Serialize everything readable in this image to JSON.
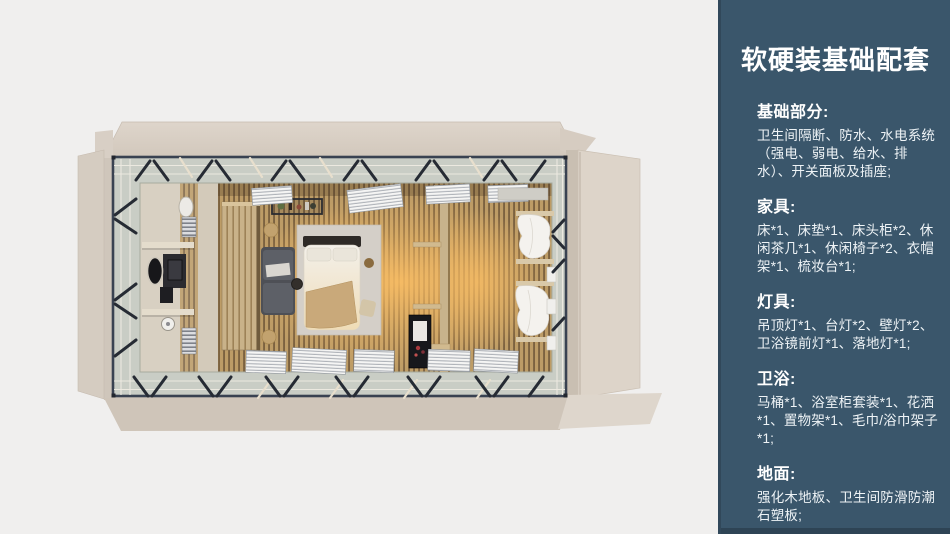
{
  "panel": {
    "title": "软硬装基础配套",
    "sections": [
      {
        "id": "basics",
        "heading": "基础部分:",
        "body": "卫生间隔断、防水、水电系统（强电、弱电、给水、排水）、开关面板及插座;"
      },
      {
        "id": "furniture",
        "heading": "家具:",
        "body": "床*1、床垫*1、床头柜*2、休闲茶几*1、休闲椅子*2、衣帽架*1、梳妆台*1;"
      },
      {
        "id": "lighting",
        "heading": "灯具:",
        "body": "吊顶灯*1、台灯*2、壁灯*2、卫浴镜前灯*1、落地灯*1;"
      },
      {
        "id": "bath",
        "heading": "卫浴:",
        "body": "马桶*1、浴室柜套装*1、花洒*1、置物架*1、毛巾/浴巾架子*1;"
      },
      {
        "id": "flooring",
        "heading": "地面:",
        "body": "强化木地板、卫生间防滑防潮石塑板;"
      }
    ]
  },
  "colors": {
    "panel-bg": "#3a566b",
    "panel-edge": "#31485a",
    "panel-footer": "#2e4455",
    "panel-text": "#ffffff",
    "canvas-bg": "#f0efee",
    "shell-beige": "#d9d0c6",
    "frame-dark": "#394251",
    "glass-band": "#c9cdc5",
    "wood-light": "#bd9c66",
    "wood-dark": "#7c6240",
    "warm-glow": "#ffc064"
  }
}
